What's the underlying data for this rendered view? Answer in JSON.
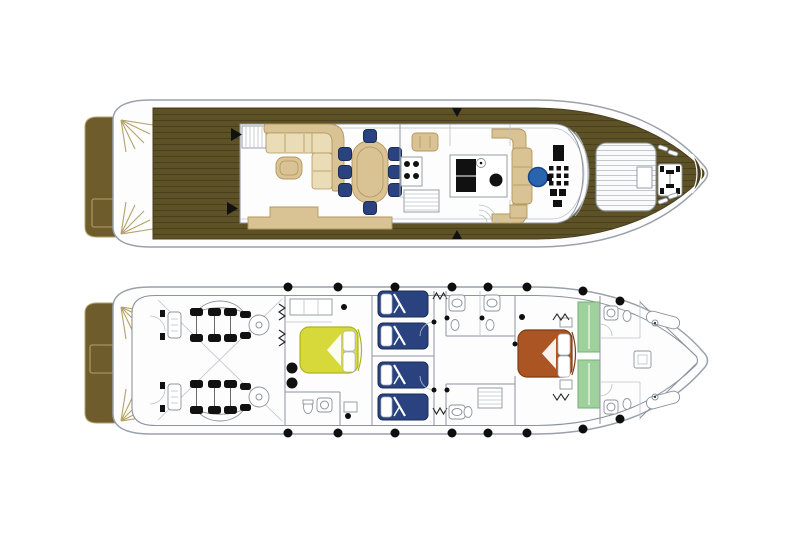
{
  "image": {
    "type": "yacht-deck-plans",
    "width": 800,
    "height": 533
  },
  "colors": {
    "background": "#ffffff",
    "hull-fill": "#fdfdfe",
    "hull-stroke": "#9aa1ab",
    "wall": "#8d949d",
    "wall-light": "#bcc2c9",
    "deck-wood": "#5d5126",
    "deck-plank": "#4a4020",
    "platform-wood": "#6e5c2d",
    "trim-gold": "#b3a269",
    "furniture-beige": "#d9c294",
    "furniture-beige-dark": "#b2975d",
    "cushion-beige": "#e9dcb6",
    "chair-navy": "#2a4380",
    "navy-dark": "#1c2d55",
    "helm-blue": "#2b64ae",
    "bed-yellow": "#d7d93b",
    "yellow-dark": "#b0b41e",
    "bed-orange": "#aa5523",
    "orange-dark": "#7e3c14",
    "wardrobe-green": "#9fd19d",
    "green-dark": "#74b175",
    "detail-black": "#111111",
    "pad-fill": "#fafbfc",
    "pad-stripe": "#c3c8cd"
  },
  "decks": [
    {
      "id": "main-deck",
      "label": "Main deck plan",
      "areas": [
        {
          "name": "swim-platform",
          "items": [
            "transom-locker",
            "stern-stairs-port",
            "stern-stairs-starboard"
          ]
        },
        {
          "name": "aft-deck",
          "surface": "teak-planks",
          "door-markers": 2
        },
        {
          "name": "salon",
          "items": [
            "flybridge-stairs",
            "l-shaped-sofa",
            "coffee-table",
            "sideboard",
            "dining-table"
          ],
          "dining-chairs": 8
        },
        {
          "name": "galley",
          "items": [
            "crew-table",
            "stove-4-burners",
            "refrigerator",
            "sink",
            "stairs-down",
            "service-door"
          ]
        },
        {
          "name": "lobby",
          "items": [
            "bench-port",
            "bench-starboard",
            "curved-stairs"
          ]
        },
        {
          "name": "wheelhouse",
          "items": [
            "helm-seat",
            "instrument-panel",
            "side-bench",
            "windshield"
          ]
        },
        {
          "name": "foredeck",
          "items": [
            "sun-pad",
            "anchor-windlass",
            "cleats",
            "bow-crescent-seat"
          ],
          "cleats": 2
        }
      ]
    },
    {
      "id": "lower-deck",
      "label": "Lower deck plan",
      "areas": [
        {
          "name": "swim-platform",
          "items": [
            "transom-locker"
          ]
        },
        {
          "name": "engine-room",
          "engines": 2
        },
        {
          "name": "vip-cabin",
          "bed": "double",
          "bed-color-ref": "bed-yellow",
          "items": [
            "ensuite-bathroom",
            "wardrobe",
            "bench"
          ]
        },
        {
          "name": "twin-cabin-port",
          "beds": 2,
          "bed-color-ref": "chair-navy"
        },
        {
          "name": "twin-cabin-starboard",
          "beds": 2,
          "bed-color-ref": "chair-navy"
        },
        {
          "name": "guest-bathrooms",
          "count": 2
        },
        {
          "name": "corridor",
          "items": [
            "companionway-stairs"
          ]
        },
        {
          "name": "master-cabin",
          "bed": "double",
          "bed-color-ref": "bed-orange",
          "wardrobes": 2,
          "wardrobe-color-ref": "wardrobe-green"
        },
        {
          "name": "crew-quarters",
          "items": [
            "v-berth",
            "bathroom-port",
            "bathroom-starboard",
            "table"
          ]
        },
        {
          "name": "portholes",
          "count": 16
        }
      ]
    }
  ]
}
